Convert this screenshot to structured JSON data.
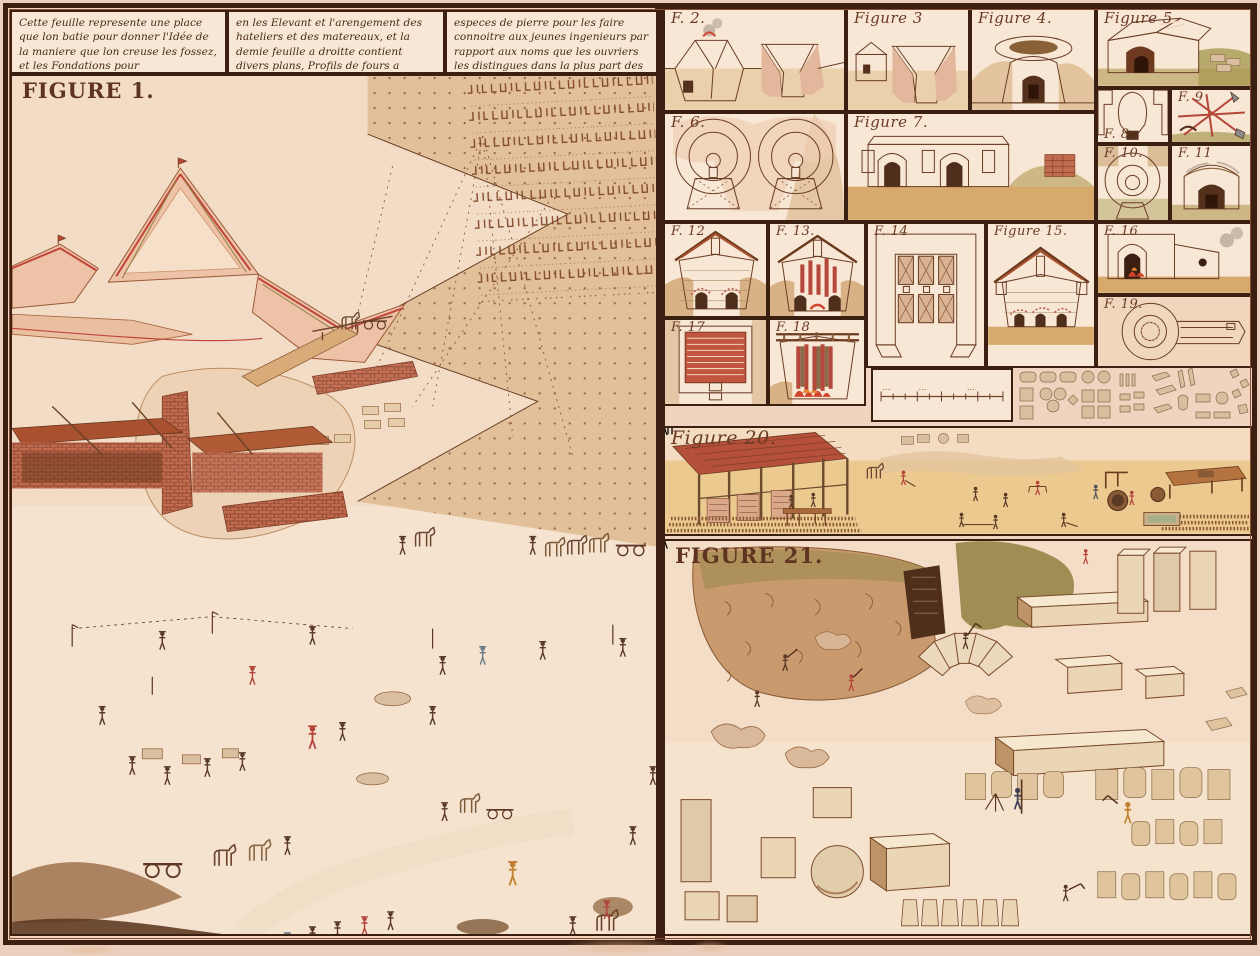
{
  "plate": {
    "header": {
      "col1": "Cette feuille represente une place que lon batie pour donner l'Idée de la maniere que lon creuse les fossez, et les Fondations pour l'établissement des murs et ce quond observe",
      "col2": "en les Elevant et l'arengement des hateliers et des matereaux, et la demie feuille a droitte contient divers plans, Profils de fours a Chaux et a brique, et dans le bas les Carieres et toutes les diferentes",
      "col3": "especes de pierre pour les faire connoitre aux jeunes ingenieurs par rapport aux noms que les ouvriers les distingues dans la plus part des provinces du royaume comme il est expliqué a la Table qui suit."
    },
    "figures": {
      "f1": "FIGURE 1.",
      "f2": "F. 2.",
      "f3": "Figure 3",
      "f4": "Figure 4.",
      "f5": "Figure 5",
      "f6": "F. 6.",
      "f7": "Figure 7.",
      "f8": "F. 8",
      "f9": "F. 9",
      "f10": "F. 10.",
      "f11": "F. 11",
      "f12": "F. 12",
      "f13": "F. 13.",
      "f14": "F. 14",
      "f15": "Figure 15.",
      "f16": "F. 16",
      "f17": "F. 17",
      "f18": "F. 18",
      "f19": "F. 19.",
      "f20": "Figure 20.",
      "f21": "FIGURE 21."
    },
    "palette": {
      "margin": "#eccfbd",
      "plate": "#efd5c0",
      "panel": "#f7e7d4",
      "frame": "#3b2012",
      "line": "#6b3e26",
      "label": "#6b3a24",
      "salmon": "#e7a58e",
      "brick": "#bb4f3c",
      "tan": "#d9ab79",
      "sand": "#ead0ab",
      "olive": "#8f7f45",
      "ink": "#4a2b17"
    }
  }
}
